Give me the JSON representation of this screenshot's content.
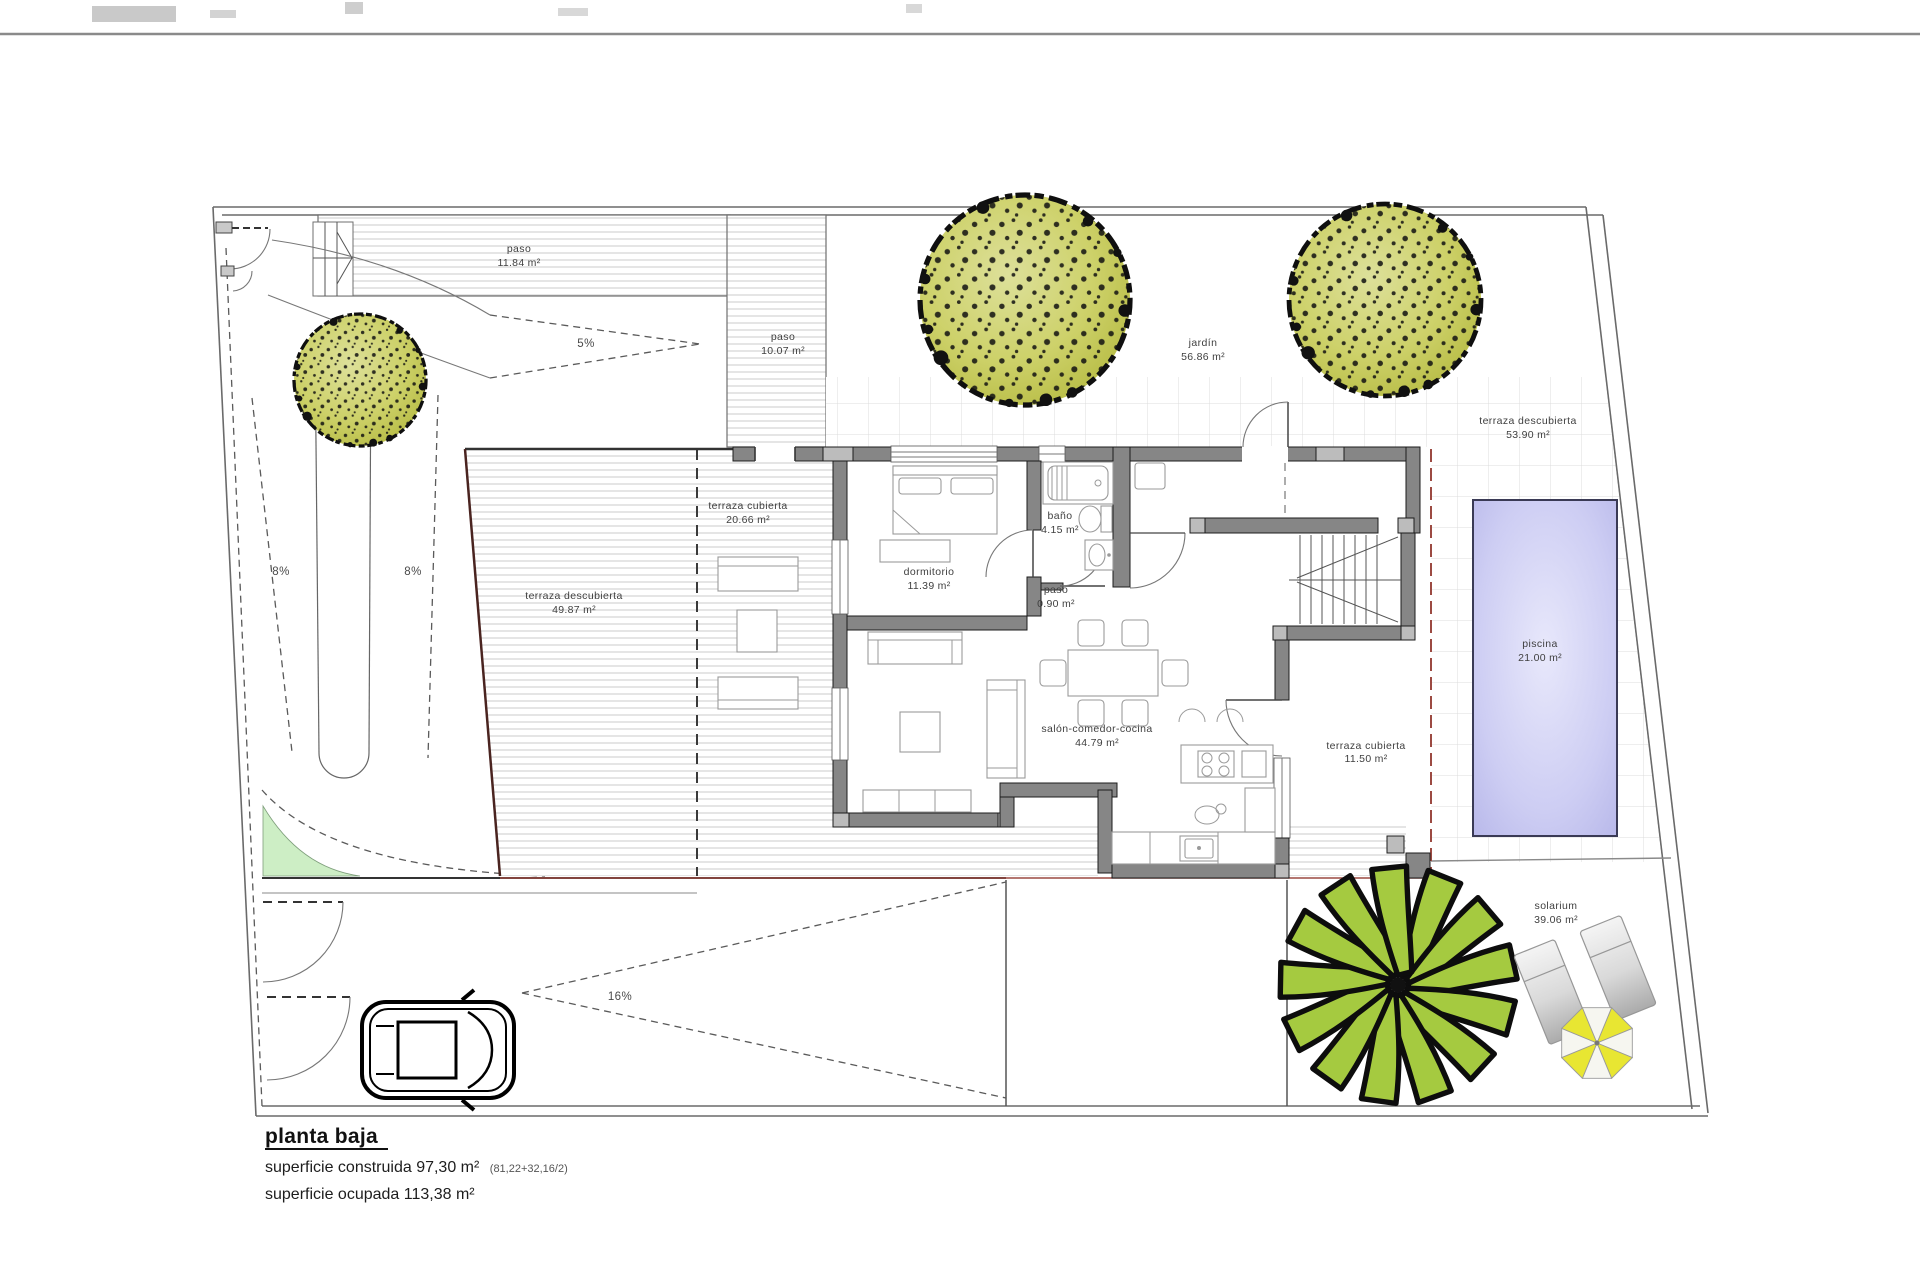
{
  "title_block": {
    "title": "planta baja",
    "construida": "superficie construida 97,30 m²",
    "construida_detail": "(81,22+32,16/2)",
    "ocupada": "superficie ocupada 113,38 m²"
  },
  "rooms": [
    {
      "name": "paso",
      "area": "11.84 m²"
    },
    {
      "name": "paso",
      "area": "10.07 m²"
    },
    {
      "name": "jardín",
      "area": "56.86 m²"
    },
    {
      "name": "terraza descubierta",
      "area": "53.90 m²"
    },
    {
      "name": "terraza cubierta",
      "area": "20.66 m²"
    },
    {
      "name": "dormitorio",
      "area": "11.39 m²"
    },
    {
      "name": "baño",
      "area": "4.15 m²"
    },
    {
      "name": "paso",
      "area": "0.90 m²"
    },
    {
      "name": "terraza descubierta",
      "area": "49.87 m²"
    },
    {
      "name": "salón-comedor-cocina",
      "area": "44.79 m²"
    },
    {
      "name": "terraza cubierta",
      "area": "11.50 m²"
    },
    {
      "name": "piscina",
      "area": "21.00 m²"
    },
    {
      "name": "solarium",
      "area": "39.06 m²"
    }
  ],
  "slopes": [
    {
      "label": "5%"
    },
    {
      "label": "8%"
    },
    {
      "label": "8%"
    },
    {
      "label": "16%"
    }
  ],
  "colors": {
    "wall": "#868686",
    "overhang_red": "#9c4a42",
    "tree_olive": "#c3c754",
    "palm_green": "#a5ca40",
    "pool_lavender": "#c2c2ee",
    "green_area": "#cdeec5",
    "parasol_yellow": "#e8e632"
  }
}
